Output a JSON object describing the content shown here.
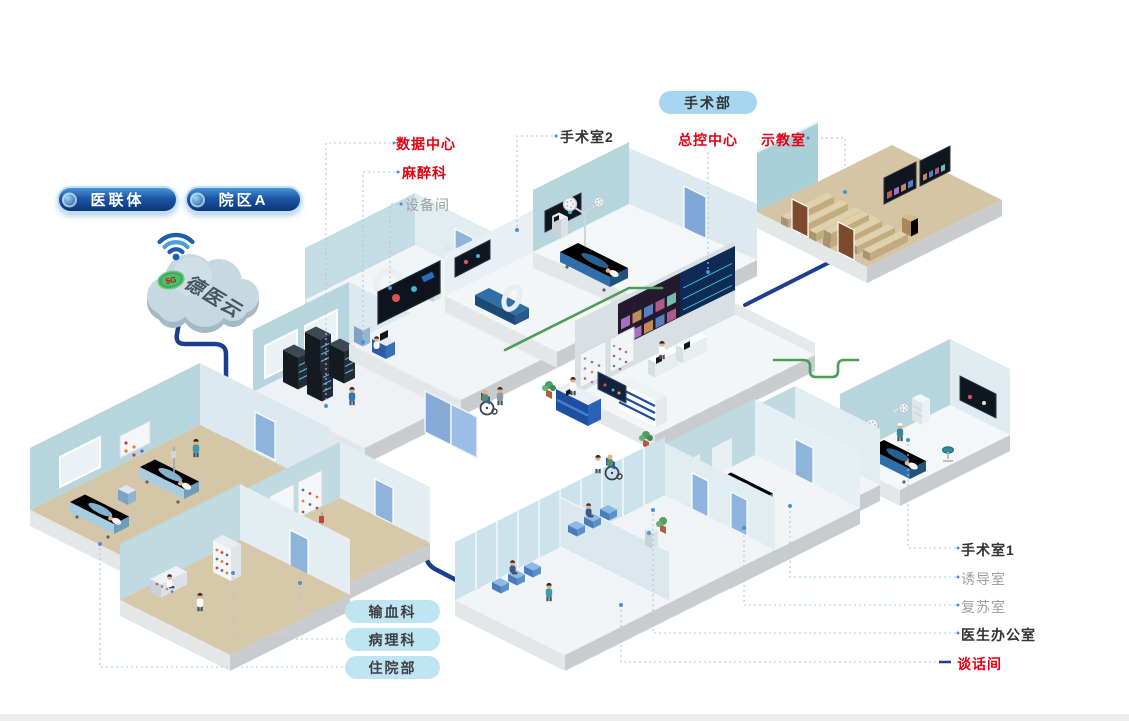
{
  "cloud": {
    "name": "德医云",
    "badge": "5G"
  },
  "tabs": {
    "alliance": "医联体",
    "campus_a": "院区A"
  },
  "surgery_badge": "手术部",
  "labels": {
    "data_center": "数据中心",
    "anesthesia": "麻醉科",
    "equipment_room": "设备间",
    "or2": "手术室2",
    "master_control": "总控中心",
    "demo_room": "示教室",
    "or1": "手术室1",
    "induction_room": "诱导室",
    "recovery_room": "复苏室",
    "doctor_office": "医生办公室",
    "talk_room": "谈话间"
  },
  "dept_pills": {
    "blood_transfusion": "输血科",
    "pathology": "病理科",
    "inpatient": "住院部"
  },
  "wall_tags": {
    "or2": "OR2",
    "or3": "OR3"
  },
  "colors": {
    "label_red": "#e60012",
    "label_dark": "#333333",
    "label_gray": "#9fa0a0",
    "leader_blue": "#a9c9e6",
    "cable_navy": "#1b3f8f",
    "cable_green": "#4a9e57",
    "pill_navy_dark": "#0d3575",
    "pill_navy_light": "#4a94d8",
    "pill_sky": "#a7d7f0",
    "pill_sky_small": "#bfe4f4",
    "wall_teal": "#b7d5de",
    "floor_tan": "#d7c6a7"
  }
}
